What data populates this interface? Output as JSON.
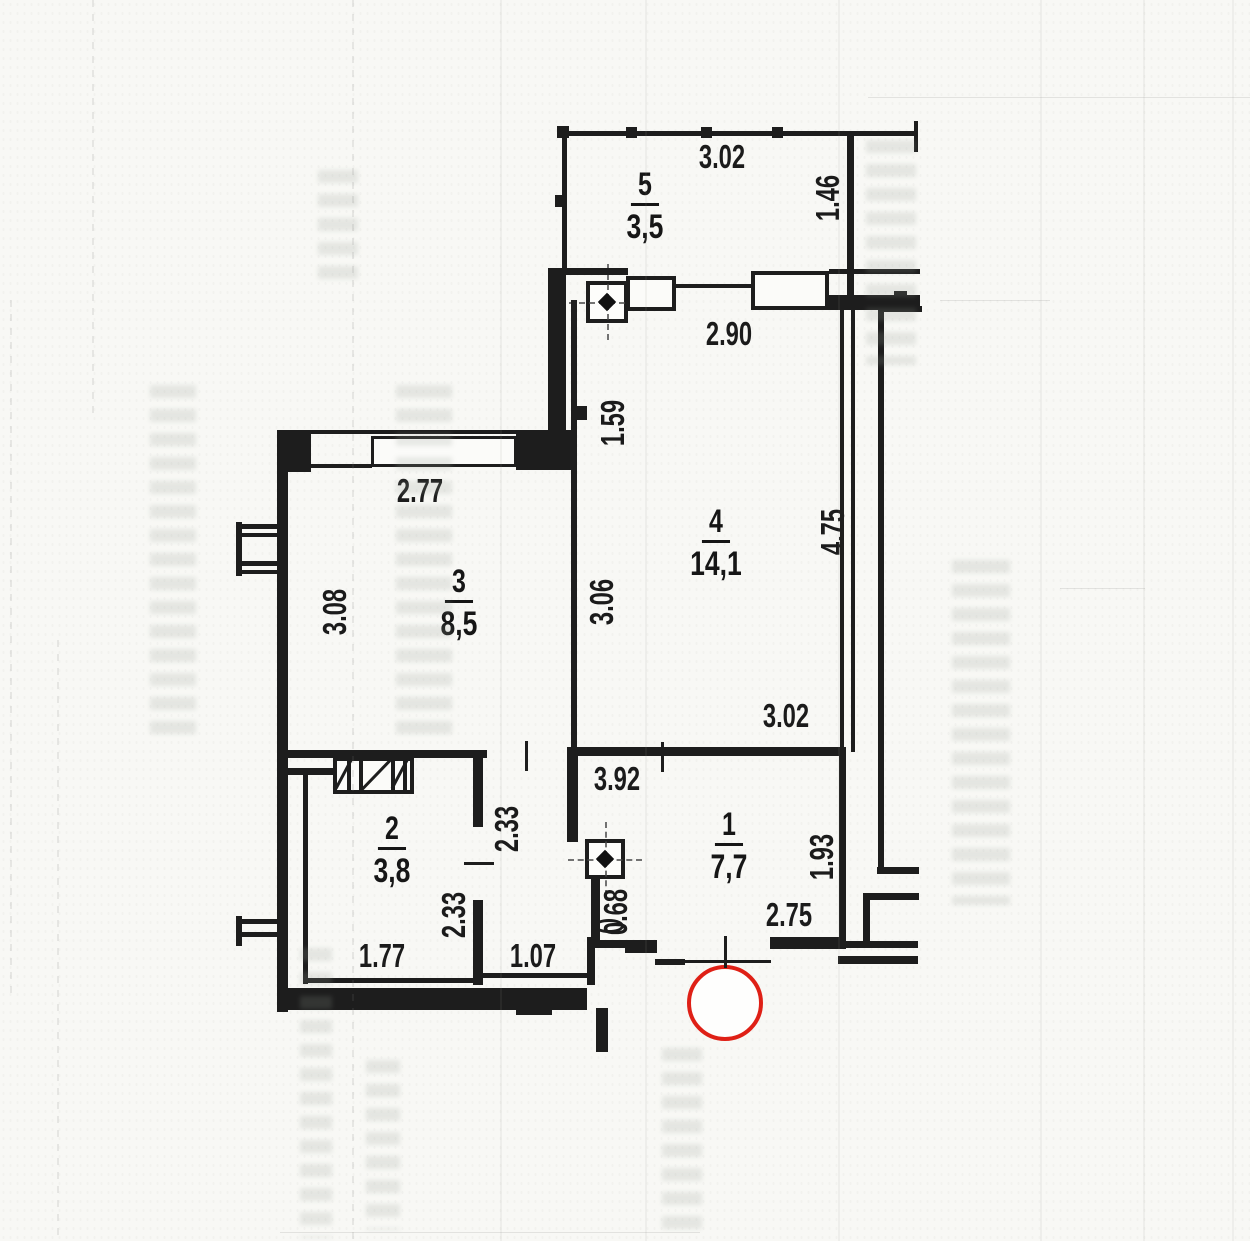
{
  "rooms": {
    "r5": {
      "number": "5",
      "area": "3,5"
    },
    "r4": {
      "number": "4",
      "area": "14,1"
    },
    "r3": {
      "number": "3",
      "area": "8,5"
    },
    "r2": {
      "number": "2",
      "area": "3,8"
    },
    "r1": {
      "number": "1",
      "area": "7,7"
    }
  },
  "dimensions": {
    "balcony_width": "3.02",
    "balcony_depth": "1.46",
    "window_wall": "2.90",
    "wall_offset": "1.59",
    "room3_width": "2.77",
    "room3_depth": "3.08",
    "room4_left_depth": "3.06",
    "room4_depth": "4.75",
    "room4_width": "3.02",
    "hall_top_width": "3.92",
    "corridor_upper_depth": "2.33",
    "corridor_lower_depth": "2.33",
    "room2_width": "1.77",
    "corridor_width": "1.07",
    "duct_offset": "0.68",
    "hall_bottom_width": "2.75",
    "hall_right_depth": "1.93"
  },
  "colors": {
    "ink": "#1d1d1d",
    "paper": "#f8f8f5",
    "entrance_marker": "#df2016"
  }
}
